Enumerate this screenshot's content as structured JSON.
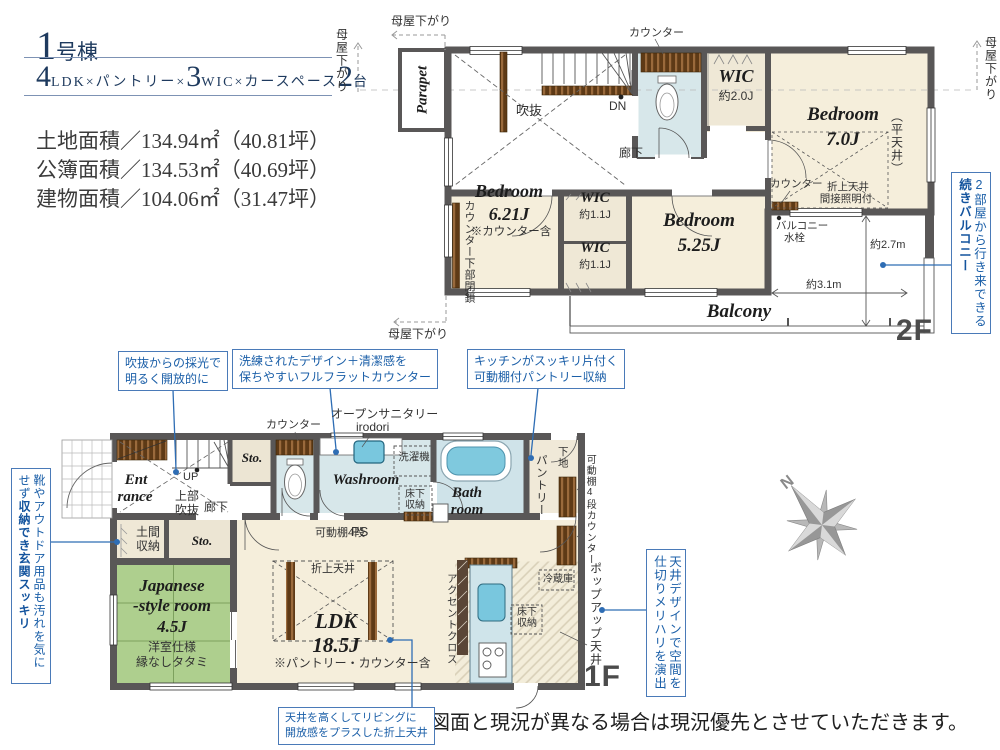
{
  "header": {
    "building_num": "1",
    "building_suffix": "号棟",
    "spec": {
      "n1": "4",
      "t1": "LDK×パントリー×",
      "n2": "3",
      "t2": "WIC×カースペース",
      "n3": "2",
      "t3": "台"
    },
    "area_land": "土地面積／134.94㎡（40.81坪）",
    "area_kobo": "公簿面積／134.53㎡（40.69坪）",
    "area_building": "建物面積／104.06㎡（31.47坪）"
  },
  "floor2": {
    "floor_label": "2F",
    "parapet": "Parapet",
    "moya_top": "母屋下がり",
    "moya_left": "母屋下がり",
    "moya_right": "母屋下がり",
    "moya_bottom": "母屋下がり",
    "toilet_counter": "カウンター",
    "void": "吹抜",
    "dn": "DN",
    "hallway": "廊下",
    "wic_main": {
      "name": "WIC",
      "size": "約2.0J"
    },
    "bedroom7": {
      "name": "Bedroom",
      "size": "7.0J",
      "flat_ceiling": "（平天井）",
      "counter": "カウンター",
      "ceiling_l1": "折上天井",
      "ceiling_l2": "間接照明付"
    },
    "bedroom621": {
      "name": "Bedroom",
      "size": "6.21J",
      "note": "※カウンター含",
      "counter_note": "カウンター下部閉鎖"
    },
    "wic_a": {
      "name": "WIC",
      "size": "約1.1J"
    },
    "wic_b": {
      "name": "WIC",
      "size": "約1.1J"
    },
    "bedroom525": {
      "name": "Bedroom",
      "size": "5.25J"
    },
    "balcony": {
      "name": "Balcony",
      "water_l1": "バルコニー",
      "water_l2": "水栓",
      "dim_v": "約2.7m",
      "dim_h": "約3.1m"
    },
    "callout": {
      "normal": "2部屋から行き来できる",
      "bold": "続きバルコニー"
    }
  },
  "floor1": {
    "floor_label": "1F",
    "callout_void": {
      "l1": "吹抜からの採光で",
      "l2": "明るく開放的に"
    },
    "callout_counter": {
      "l1": "洗練されたデザイン＋清潔感を",
      "l2": "保ちやすいフルフラットカウンター"
    },
    "callout_pantry": {
      "l1": "キッチンがスッキリ片付く",
      "l2": "可動棚付パントリー収納"
    },
    "callout_entrance": {
      "normal": "靴やアウトドア用品も汚れを気にせず",
      "bold": "収納でき玄関スッキリ"
    },
    "callout_ceiling": "天井デザインで空間を仕切りメリハリを演出",
    "callout_living": {
      "l1": "天井を高くしてリビングに",
      "l2": "開放感をプラスした折上天井"
    },
    "open_sanitary_l1": "オープンサニタリー",
    "open_sanitary_l2": "irodori",
    "toilet_counter": "カウンター",
    "entrance_l1": "Ent",
    "entrance_l2": "rance",
    "up": "UP",
    "void_l1": "上部",
    "void_l2": "吹抜",
    "hallway": "廊下",
    "sto_upper": "Sto.",
    "sto_lower": "Sto.",
    "doma_l1": "土間",
    "doma_l2": "収納",
    "washroom": "Washroom",
    "washer": "洗濯機",
    "floor_storage_l1": "床下",
    "floor_storage_l2": "収納",
    "bath_l1": "Bath",
    "bath_l2": "room",
    "pantry": "パントリー",
    "shitaji": "下地",
    "shelf_right": "可動棚4段",
    "counter_right": "カウンター",
    "popup_ceiling": "ポップアップ天井",
    "shelf_ps": "可動棚4段",
    "ps": "PS",
    "oriage": "折上天井",
    "ldk_name": "LDK",
    "ldk_size": "18.5J",
    "ldk_note": "※パントリー・カウンター含",
    "accent": "アクセントクロス",
    "fridge": "冷蔵庫",
    "kitchen_storage_l1": "床下",
    "kitchen_storage_l2": "収納",
    "japanese": {
      "l1": "Japanese",
      "l2": "-style room",
      "l3": "4.5J",
      "l4": "洋室仕様",
      "l5": "縁なしタタミ"
    }
  },
  "compass": "N",
  "disclaimer": "図面と現況が異なる場合は現況優先とさせていただきます。",
  "colors": {
    "wall": "#595757",
    "cream": "#f5eedb",
    "wet": "#d7e7ea",
    "tatami": "#aecf8e",
    "accent_blue": "#1b5fa8"
  }
}
